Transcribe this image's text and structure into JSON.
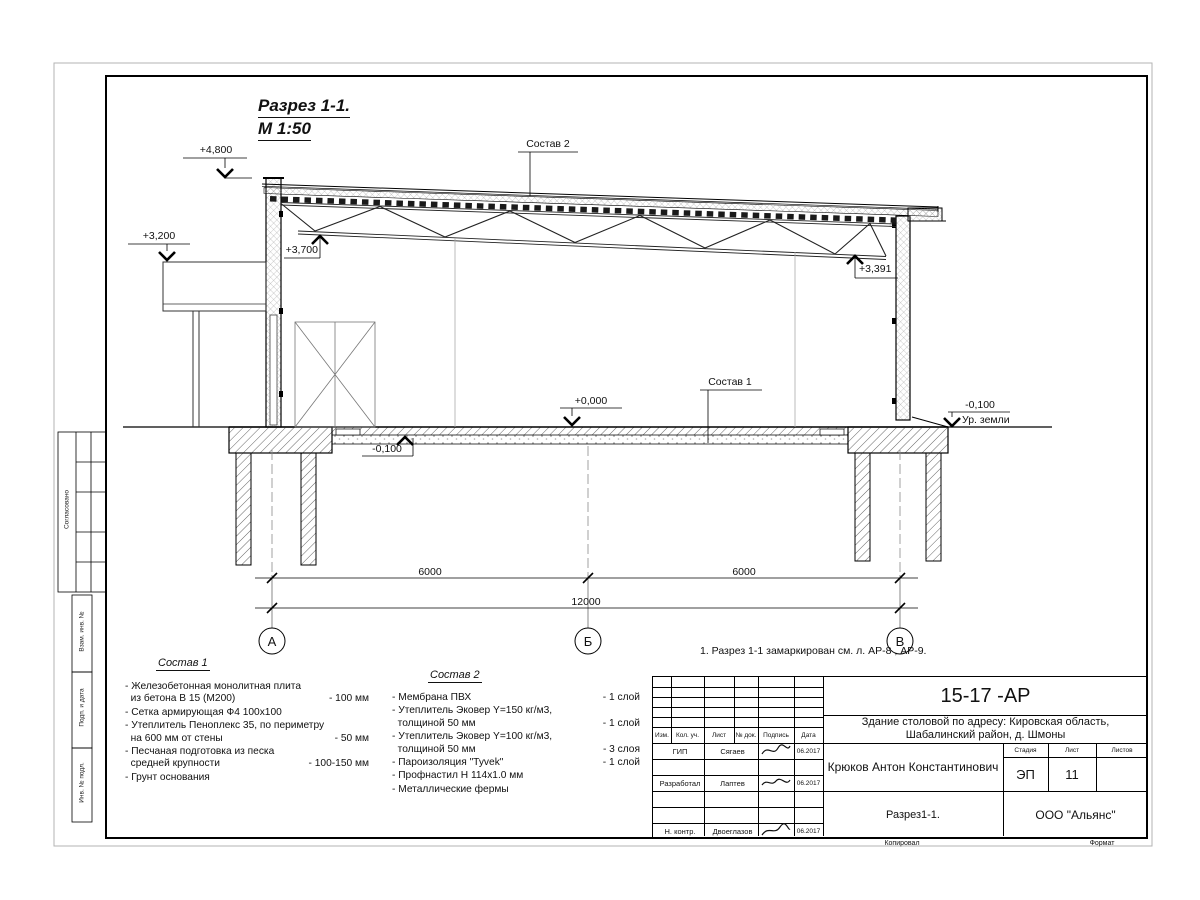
{
  "drawing": {
    "title_line1": "Разрез 1-1.",
    "title_line2": "М 1:50",
    "elevations": {
      "top": "+4,800",
      "canopy": "+3,200",
      "truss_left": "+3,700",
      "truss_right": "+3,391",
      "floor": "+0,000",
      "slab_bottom": "-0,100",
      "ground": "-0,100",
      "ground_label": "Ур. земли"
    },
    "callouts": {
      "roof": "Состав 2",
      "floor": "Состав 1"
    },
    "dimensions": {
      "span1": "6000",
      "span2": "6000",
      "total": "12000"
    },
    "axes": {
      "left": "А",
      "middle": "Б",
      "right": "В"
    },
    "note": "1. Разрез 1-1 замаркирован см. л. АР-8 , АР-9."
  },
  "legend1": {
    "title": "Состав 1",
    "items": [
      {
        "text": "- Железобетонная  монолитная плита\n  из бетона В 15 (М200)",
        "value": "- 100 мм"
      },
      {
        "text": "- Сетка армирующая Ф4 100х100",
        "value": ""
      },
      {
        "text": "- Утеплитель Пеноплекс 35, по периметру\n  на 600 мм от стены",
        "value": "- 50 мм"
      },
      {
        "text": "- Песчаная подготовка из песка\n  средней крупности",
        "value": "- 100-150 мм"
      },
      {
        "text": "- Грунт основания",
        "value": ""
      }
    ]
  },
  "legend2": {
    "title": "Состав 2",
    "items": [
      {
        "text": "- Мембрана ПВХ",
        "value": "- 1 слой"
      },
      {
        "text": "- Утеплитель Эковер Y=150 кг/м3,\n  толщиной 50 мм",
        "value": "- 1 слой"
      },
      {
        "text": "- Утеплитель Эковер Y=100 кг/м3,\n  толщиной 50 мм",
        "value": "- 3 слоя"
      },
      {
        "text": "- Пароизоляция \"Tyvek\"",
        "value": "- 1 слой"
      },
      {
        "text": "- Профнастил Н 114х1.0 мм",
        "value": ""
      },
      {
        "text": "- Металлические фермы",
        "value": ""
      }
    ]
  },
  "margin_labels": {
    "approved": "Согласовано",
    "vzam": "Взам. инв. №",
    "podp": "Подп. и дата",
    "inv": "Инв. № подл."
  },
  "titleblock": {
    "code": "15-17 -АР",
    "project": "Здание столовой по адресу: Кировская область,\nШабалинский район, д. Шмоны",
    "author": "Крюков Антон Константинович",
    "sheet_name": "Разрез1-1.",
    "company": "ООО \"Альянс\"",
    "cols": {
      "izm": "Изм.",
      "kol": "Кол. уч.",
      "list": "Лист",
      "doc": "№ док.",
      "sign": "Подпись",
      "date": "Дата"
    },
    "stage_label": "Стадия",
    "sheet_label": "Лист",
    "sheets_label": "Листов",
    "stage": "ЭП",
    "sheet_num": "11",
    "sheets_total": "",
    "rows": [
      {
        "role": "ГИП",
        "name": "Сягаев",
        "date": "06.2017"
      },
      {
        "role": "Разработал",
        "name": "Лаптев",
        "date": "06.2017"
      },
      {
        "role": "Н. контр.",
        "name": "Двоеглазов",
        "date": "06.2017"
      }
    ],
    "footer": {
      "copied": "Копировал",
      "format": "Формат"
    }
  }
}
